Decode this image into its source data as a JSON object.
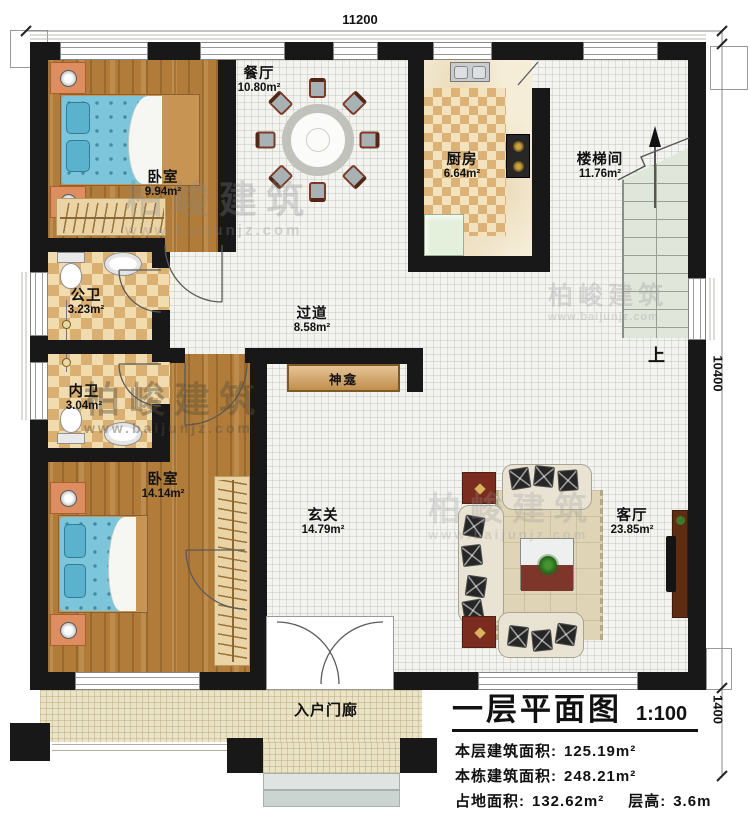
{
  "page": {
    "type": "floor-plan-drawing"
  },
  "title_block": {
    "title": "一层平面图",
    "scale": "1:100",
    "stats": {
      "floor_area_label": "本层建筑面积:",
      "floor_area_value": "125.19m²",
      "building_area_label": "本栋建筑面积:",
      "building_area_value": "248.21m²",
      "footprint_label": "占地面积:",
      "footprint_value": "132.62m²",
      "height_label": "层高:",
      "height_value": "3.6m"
    }
  },
  "dimensions": {
    "top_width": "11200",
    "right_height": "10400",
    "porch_depth": "1400"
  },
  "rooms": {
    "bedroom_top": {
      "name": "卧室",
      "area": "9.94m²"
    },
    "dining": {
      "name": "餐厅",
      "area": "10.80m²"
    },
    "kitchen": {
      "name": "厨房",
      "area": "6.64m²"
    },
    "stairwell": {
      "name": "楼梯间",
      "area": "11.76m²"
    },
    "bath_public": {
      "name": "公卫",
      "area": "3.23m²"
    },
    "bath_private": {
      "name": "内卫",
      "area": "3.04m²"
    },
    "corridor": {
      "name": "过道",
      "area": "8.58m²"
    },
    "bedroom_bottom": {
      "name": "卧室",
      "area": "14.14m²"
    },
    "foyer": {
      "name": "玄关",
      "area": "14.79m²"
    },
    "living": {
      "name": "客厅",
      "area": "23.85m²"
    },
    "porch": {
      "name": "入户门廊"
    }
  },
  "features": {
    "shrine": "神龛",
    "stairs_up_label": "上"
  },
  "watermark": {
    "brand": "柏峻建筑",
    "site": "www.baijunjz.com"
  },
  "colors": {
    "wall": "#181818",
    "wood_floor": "#b17c3a",
    "tile_floor": "#f3f3f0",
    "bath_tile": "#d9af72",
    "stair_fill": "#e0e6da",
    "porch_fill": "#ebe3c6",
    "bed_blue": "#7cc5da",
    "shrine_wood": "#d9a45f"
  }
}
